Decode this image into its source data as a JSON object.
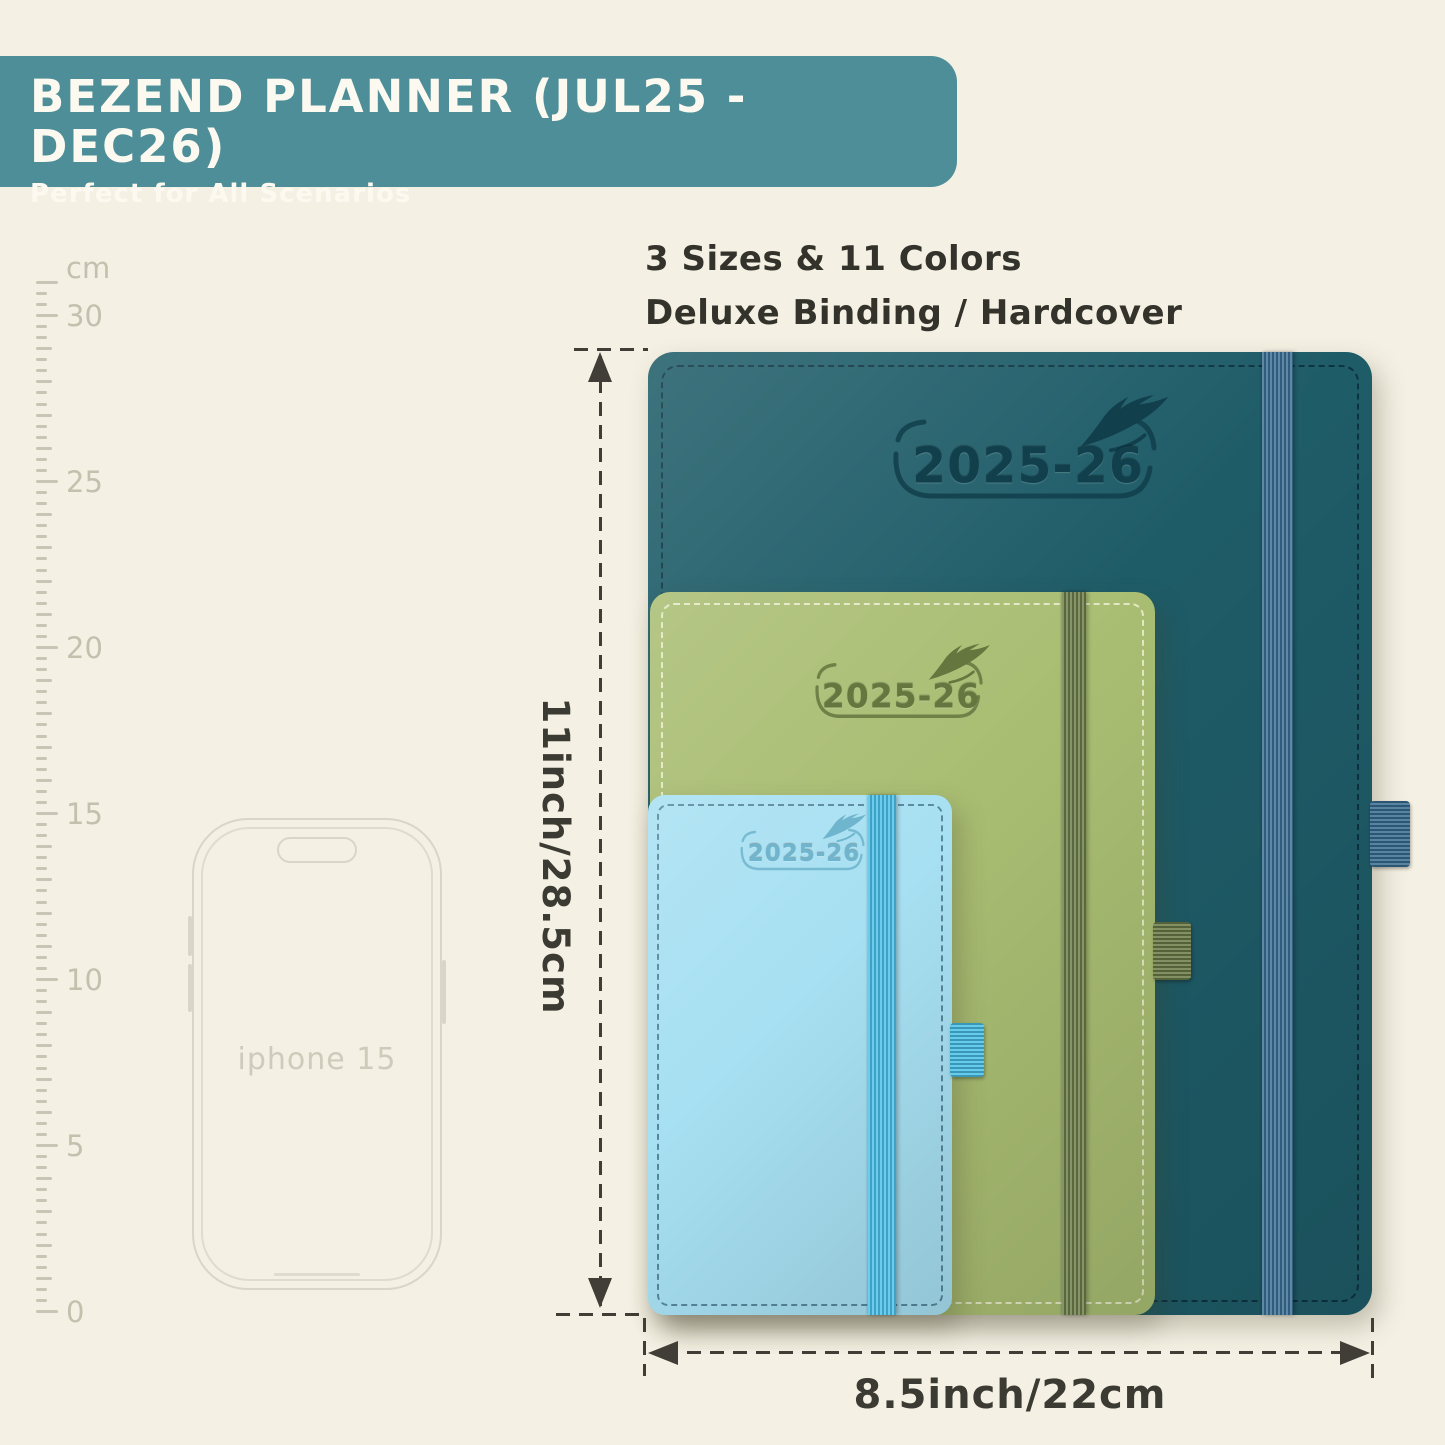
{
  "banner": {
    "title": "BEZEND PLANNER (JUL25 - DEC26)",
    "subtitle": "Perfect for All Scenarios",
    "bg": "#4e8e98",
    "text_color": "#fcfaf0"
  },
  "features": {
    "line1": "3 Sizes & 11 Colors",
    "line2": "Deluxe Binding / Hardcover"
  },
  "ruler": {
    "unit_label": "cm",
    "tick_labels": [
      "30",
      "25",
      "20",
      "15",
      "10",
      "5",
      "0"
    ],
    "max_cm": 31
  },
  "phone": {
    "label": "iphone 15"
  },
  "planners": [
    {
      "name": "large-teal",
      "year_label": "2025-26",
      "cover": "#1e5c68",
      "band": "#3a6e92",
      "emboss": "#113f4b"
    },
    {
      "name": "medium-green",
      "year_label": "2025-26",
      "cover": "#a9bd72",
      "band": "#6c7c49",
      "emboss": "#66763f"
    },
    {
      "name": "small-blue",
      "year_label": "2025-26",
      "cover": "#a7e0f2",
      "band": "#4bc1e9",
      "emboss": "#6fb5cd"
    }
  ],
  "dimensions": {
    "height_label": "11inch/28.5cm",
    "width_label": "8.5inch/22cm"
  }
}
